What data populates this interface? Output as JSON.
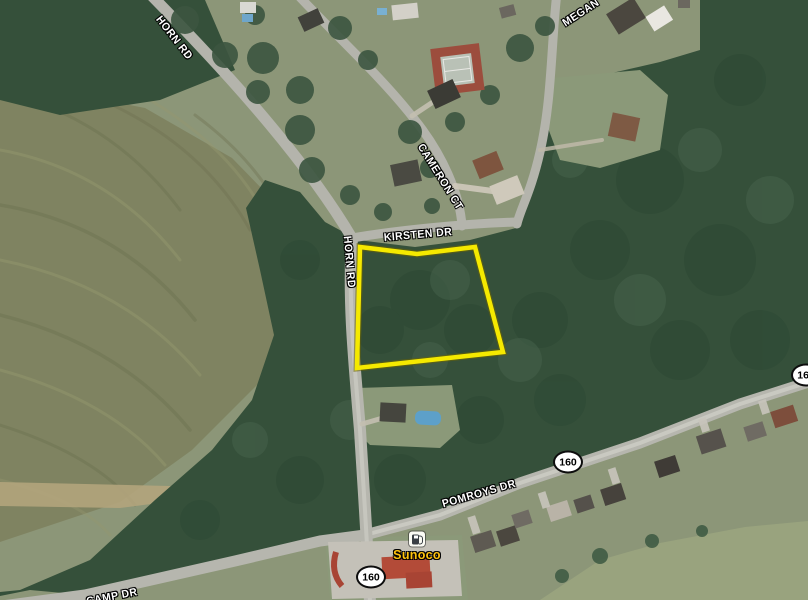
{
  "road_labels": {
    "horn_rd_upper": "HORN RD",
    "megan": "MEGAN",
    "cameron_ct": "CAMERON CT",
    "kirsten_dr": "KIRSTEN DR",
    "horn_rd_lower": "HORN RD",
    "pomroys_dr": "POMROYS DR",
    "camp_dr": "CAMP DR"
  },
  "route_shield": {
    "number": "160"
  },
  "poi": {
    "gas_station": {
      "name": "Sunoco",
      "icon": "gas-pump-icon",
      "label_color": "#ffc20e"
    }
  },
  "parcel": {
    "outline_color": "#f5e900"
  },
  "colors": {
    "lawn": "#8c9678",
    "field": "#7f8361",
    "forest": "#35503a",
    "road": "#b6b6ae",
    "water_pool": "#5da0c9"
  }
}
